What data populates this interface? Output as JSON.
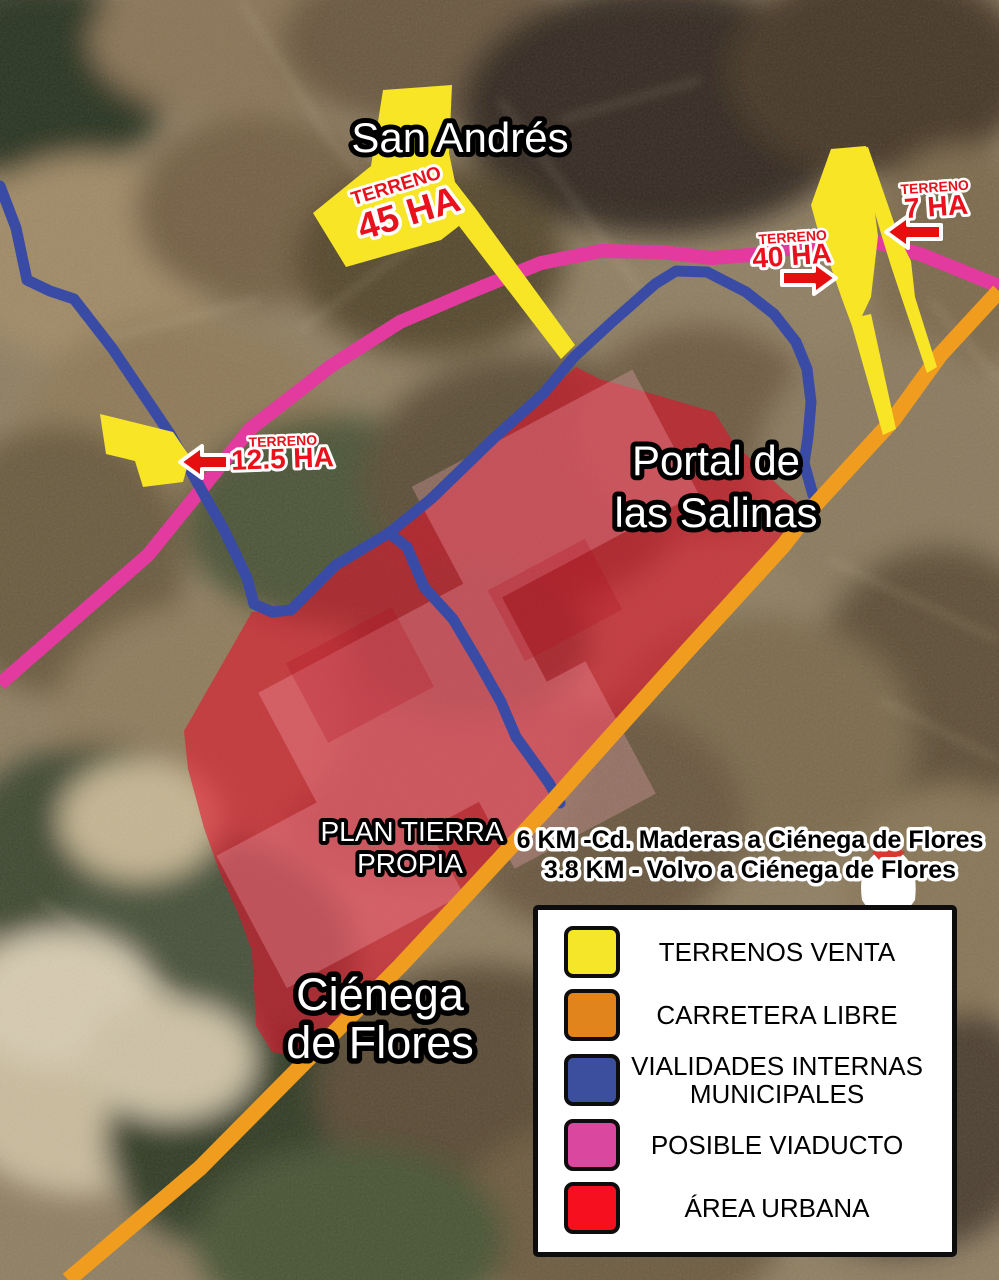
{
  "map": {
    "place_labels": {
      "san_andres": "San Andrés",
      "portal_line1": "Portal de",
      "portal_line2": "las Salinas",
      "plan_line1": "PLAN TIERRA",
      "plan_line2": "PROPIA",
      "cienega_line1": "Ciénega",
      "cienega_line2": "de Flores"
    },
    "parcels": {
      "p45": {
        "kicker": "TERRENO",
        "area": "45 HA"
      },
      "p40": {
        "kicker": "TERRENO",
        "area": "40 HA"
      },
      "p7": {
        "kicker": "TERRENO",
        "area": "7 HA"
      },
      "p12_5": {
        "kicker": "TERRENO",
        "area": "12.5 HA"
      }
    },
    "distance_notes": {
      "line1": "6 KM -Cd. Maderas a Ciénega de Flores",
      "line2": "3.8 KM - Volvo a Ciénega de Flores"
    }
  },
  "legend": {
    "items": [
      {
        "label": "TERRENOS VENTA",
        "color": "#F6E62A"
      },
      {
        "label": "CARRETERA LIBRE",
        "color": "#E2841C"
      },
      {
        "label": "VIALIDADES INTERNAS MUNICIPALES",
        "color": "#3C4F9F"
      },
      {
        "label": "POSIBLE VIADUCTO",
        "color": "#D9479E"
      },
      {
        "label": "ÁREA URBANA",
        "color": "#F6101F"
      }
    ]
  },
  "colors": {
    "terrenos_venta": "#F8E526",
    "carretera_libre": "#F09C1E",
    "vialidades_internas": "#3A4BA6",
    "posible_viaducto": "#E23A9E",
    "area_urbana": "#E5122B",
    "terreno_label": "#E8111C",
    "arrow": "#E60F0F"
  }
}
